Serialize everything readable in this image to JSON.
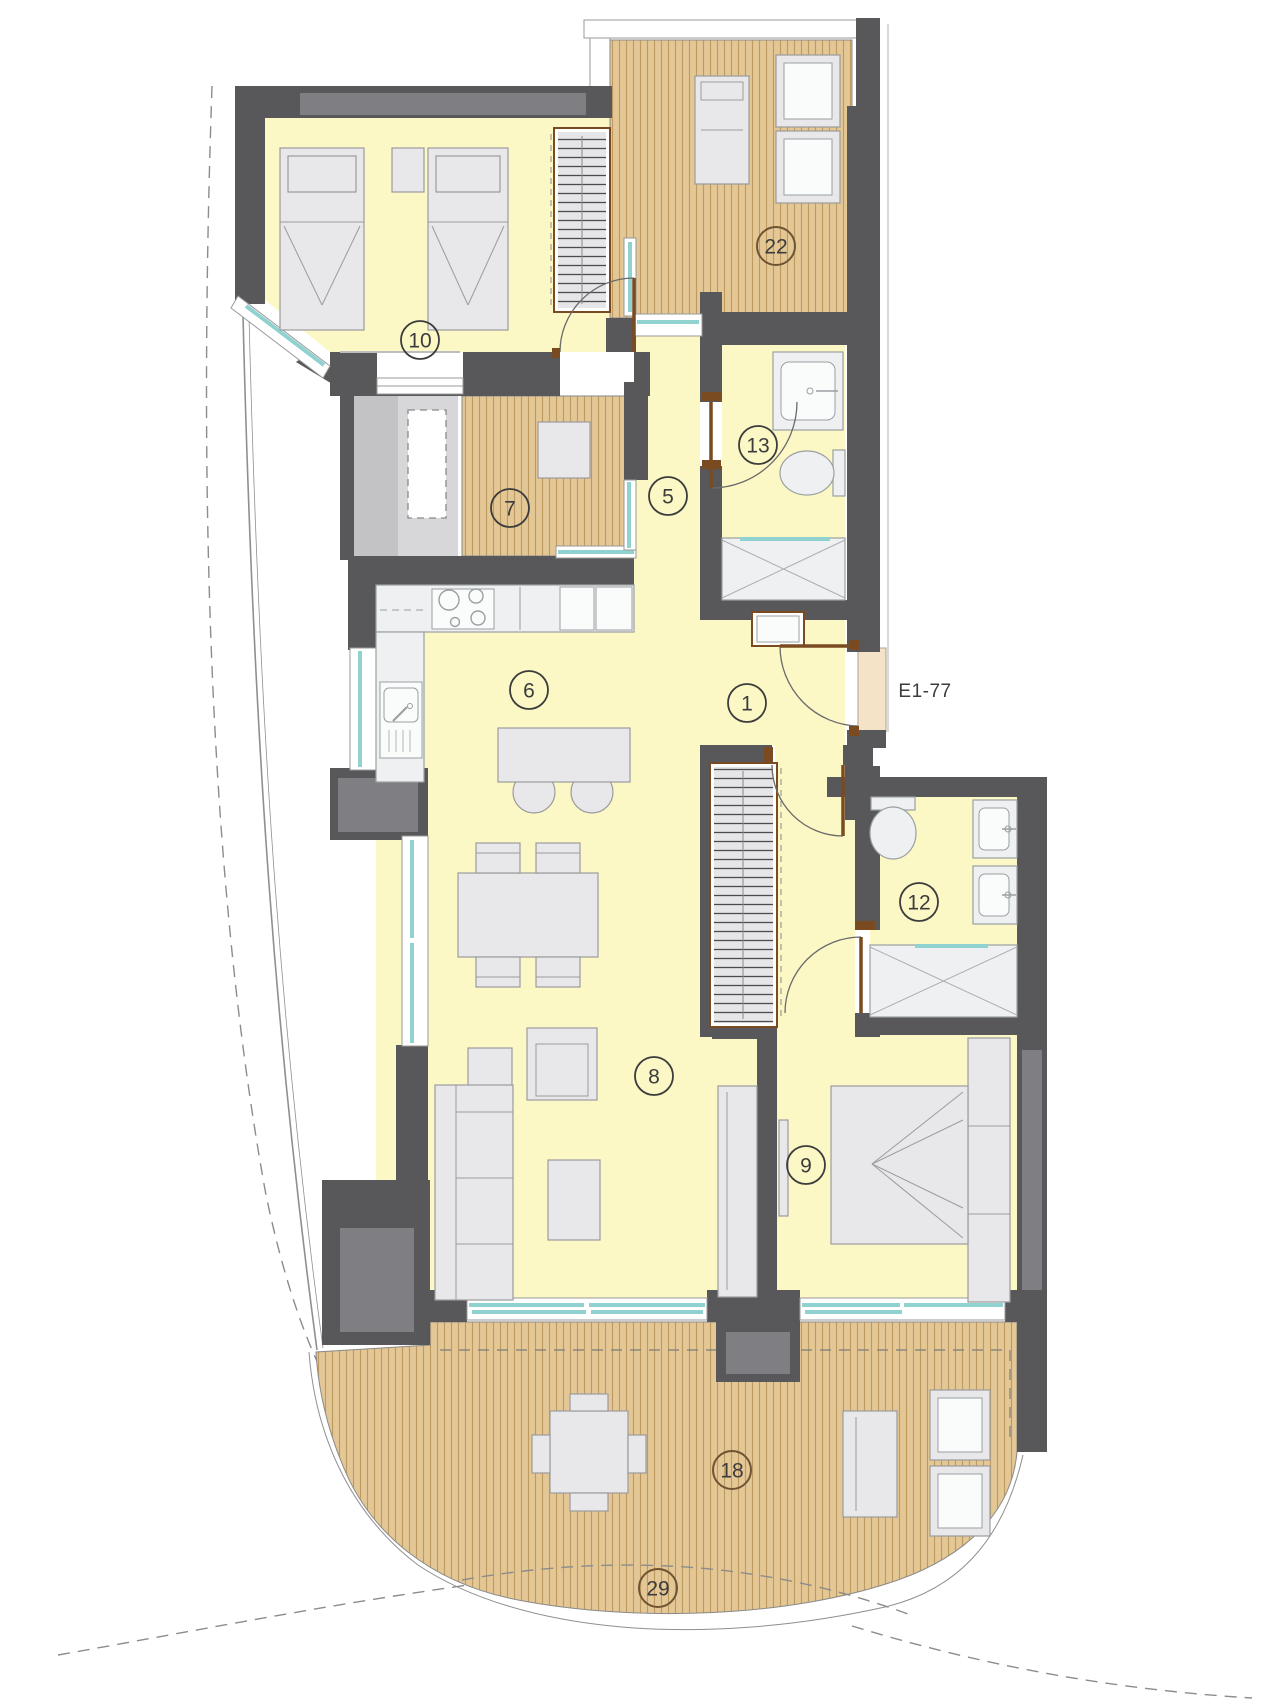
{
  "plan": {
    "type": "apartment-floor-plan",
    "unit": "E1-77"
  },
  "entrance": {
    "label": "E1-77"
  },
  "rooms": [
    {
      "number": "10",
      "name": "bedroom-2"
    },
    {
      "number": "22",
      "name": "terrace-top"
    },
    {
      "number": "7",
      "name": "patio-deck"
    },
    {
      "number": "5",
      "name": "hallway"
    },
    {
      "number": "13",
      "name": "bathroom-2"
    },
    {
      "number": "6",
      "name": "kitchen"
    },
    {
      "number": "1",
      "name": "entrance-hall"
    },
    {
      "number": "12",
      "name": "bathroom-1"
    },
    {
      "number": "8",
      "name": "living-room"
    },
    {
      "number": "9",
      "name": "bedroom-1"
    },
    {
      "number": "18",
      "name": "terrace-bottom"
    },
    {
      "number": "29",
      "name": "terrace-edge"
    }
  ],
  "colors": {
    "wall": "#58585a",
    "wall_light": "#7f7f83",
    "floor": "#fbf8c6",
    "deck": "#e3c795",
    "deck_stripe": "#bf9a60",
    "glass": "#8fd2cf",
    "furn": "#e8e8ea",
    "furn_stroke": "#9b9b9e",
    "fixture": "#eef0f1",
    "door_wood": "#7a4a21",
    "label_ink": "#3c3c3c",
    "terrace_label": "#6f5434",
    "site_line": "#8f8f8f",
    "landing": "#f5e3c8",
    "utility": "#d7d7d9",
    "shaft": "#c3c3c6"
  }
}
